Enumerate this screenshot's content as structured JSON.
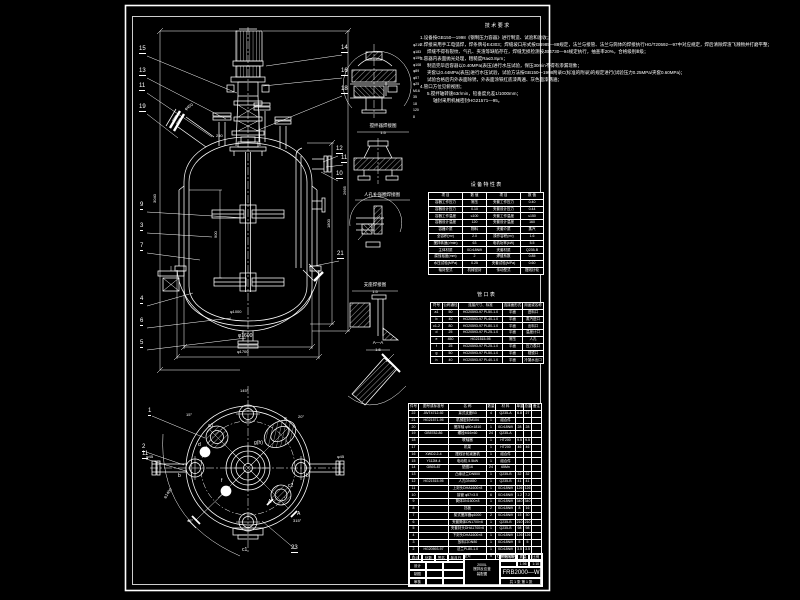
{
  "drawing": {
    "background": "#000000",
    "line_color": "#ffffff",
    "number": "FRB2000—W",
    "type_label": "搅拌反应釜装配图"
  },
  "notes": {
    "title": "技 术 要 求",
    "lines": [
      {
        "t": "1.设备按GB150—1998《钢制压力容器》进行制造、试验和验收；",
        "x": 420,
        "y": 36
      },
      {
        "t": "2.焊接采用手工电弧焊，焊条牌号E4303；焊缝坡口形式按GB985—88规定，法兰与接管、法兰与筒体的焊接执行HG/T20592—97中对应规定，焊后清除焊渣飞溅物并打磨平整；",
        "x": 420,
        "y": 43
      },
      {
        "t": "焊缝不得有裂纹、气孔、夹渣等缺陷存在，焊缝无损检测按JB4730—94规定执行，抽查率20%，合格级别Ⅲ级；",
        "x": 427,
        "y": 50
      },
      {
        "t": "3.容器内表面抛光处理，粗糙度Ra≤0.8μm；",
        "x": 420,
        "y": 57
      },
      {
        "t": "制造完毕后容器以0.40MPa(表压)进行水压试验，保压30min不得有渗漏现象；",
        "x": 427,
        "y": 64
      },
      {
        "t": "夹套以0.44MPa(表压)进行水压试验，试验方法按GB150—1998附录C(标准的附录)的规定进行(试验压力0.25MPa/夹套0.60MPa)；",
        "x": 427,
        "y": 71
      },
      {
        "t": "试验合格后内外表面除锈，外表面涂铁红底漆两遍、灰色面漆两遍；",
        "x": 427,
        "y": 78
      },
      {
        "t": "4.管口方位见俯视图；",
        "x": 420,
        "y": 85
      },
      {
        "t": "5.搅拌轴转速63r/min，铅垂度允差1/1000mm；",
        "x": 427,
        "y": 92
      },
      {
        "t": "轴封采用机械密封HG21571—95。",
        "x": 433,
        "y": 99
      }
    ]
  },
  "char_table": {
    "title": "设 备 特 性 表",
    "headers": [
      "项  目",
      "数  值",
      "项  目",
      "数  值"
    ],
    "widths": [
      34,
      24,
      34,
      23
    ],
    "rows": [
      [
        "容器工作压力",
        "常压",
        "夹套工作压力",
        "0.40"
      ],
      [
        "容器设计压力",
        "0.10",
        "夹套设计压力",
        "0.44"
      ],
      [
        "容器工作温度",
        "≤100",
        "夹套工作温度",
        "≤150"
      ],
      [
        "容器设计温度",
        "120",
        "夹套设计温度",
        "160"
      ],
      [
        "容器介质",
        "物料",
        "夹套介质",
        "蒸汽"
      ],
      [
        "全容积(m³)",
        "2.0",
        "操作容积(m³)",
        "1.6"
      ],
      [
        "搅拌转速(r/min)",
        "63",
        "电机功率(kW)",
        "5.5"
      ],
      [
        "主体材质",
        "0Cr18Ni9",
        "夹套材质",
        "Q235-B"
      ],
      [
        "腐蚀裕度(mm)",
        "2",
        "焊缝系数",
        "0.85"
      ],
      [
        "水压试验(MPa)",
        "0.25",
        "夹套试验(MPa)",
        "0.60"
      ],
      [
        "轴封型式",
        "机械密封",
        "传动型式",
        "摆线针轮"
      ]
    ]
  },
  "nozzle_table": {
    "title": "管 口 表",
    "headers": [
      "符号",
      "公称通径",
      "连接尺寸、标准",
      "连接面形式",
      "用途或名称"
    ],
    "widths": [
      12,
      16,
      44,
      20,
      21
    ],
    "rows": [
      [
        "a1",
        "50",
        "HG20593-97 PL50-1.0",
        "平面",
        "进料口"
      ],
      [
        "b",
        "40",
        "HG20593-97 PL40-1.0",
        "平面",
        "蒸汽进口"
      ],
      [
        "c1-2",
        "80",
        "HG20593-97 PL80-1.0",
        "平面",
        "出料口"
      ],
      [
        "d",
        "25",
        "HG20593-97 PL25-1.0",
        "平面",
        "温度计口"
      ],
      [
        "e",
        "450",
        "HG21515-95",
        "常压",
        "人孔"
      ],
      [
        "f",
        "25",
        "HG20593-97 PL25-1.0",
        "平面",
        "压力表口"
      ],
      [
        "g",
        "50",
        "HG20593-97 PL50-1.0",
        "平面",
        "视镜口"
      ],
      [
        "h",
        "40",
        "HG20593-97 PL40-1.0",
        "平面",
        "冷凝水出口"
      ]
    ]
  },
  "bom": {
    "headers": [
      "件号",
      "图号或标准号",
      "名  称",
      "数量",
      "材  料",
      "单重",
      "总重",
      "备注"
    ],
    "widths": [
      10,
      30,
      38,
      9,
      20,
      8,
      8,
      10
    ],
    "rows": [
      [
        "22",
        "JB/T4712-92",
        "耳式支座B3",
        "4",
        "Q235-A",
        "6.8",
        "27",
        ""
      ],
      [
        "21",
        "HG21571-95",
        "机械密封M104",
        "1",
        "组合件",
        "",
        "",
        ""
      ],
      [
        "20",
        "",
        "搅拌轴 φ50×1810",
        "1",
        "0Cr18Ni9",
        "28",
        "28",
        ""
      ],
      [
        "19",
        "GB5782-86",
        "螺栓M16×60",
        "24",
        "Q235-A",
        "",
        "",
        ""
      ],
      [
        "18",
        "",
        "联轴器",
        "1",
        "HT200",
        "9.5",
        "9.5",
        ""
      ],
      [
        "17",
        "",
        "机架",
        "1",
        "HT200",
        "46",
        "46",
        ""
      ],
      [
        "16",
        "XWD2.2-4",
        "摆线针轮减速机",
        "1",
        "组合件",
        "",
        "",
        ""
      ],
      [
        "15",
        "Y112M-4",
        "电动机 5.5kW",
        "1",
        "组合件",
        "",
        "",
        ""
      ],
      [
        "14",
        "GB93-87",
        "垫圈16",
        "24",
        "65Mn",
        "",
        "",
        ""
      ],
      [
        "13",
        "",
        "凸缘法兰DN500",
        "1",
        "Q235-B",
        "32",
        "32",
        ""
      ],
      [
        "12",
        "HG21515-95",
        "人孔DN450",
        "1",
        "Q235-B",
        "41",
        "41",
        ""
      ],
      [
        "11",
        "",
        "上封头DHA1600×8",
        "1",
        "0Cr18Ni9",
        "126",
        "126",
        ""
      ],
      [
        "10",
        "",
        "接管 φ57×3.5",
        "6",
        "0Cr18Ni9",
        "1.2",
        "7.2",
        ""
      ],
      [
        "9",
        "",
        "筒体DN1600×8",
        "1",
        "0Cr18Ni9",
        "340",
        "340",
        ""
      ],
      [
        "8",
        "",
        "挡板",
        "2",
        "0Cr18Ni9",
        "8",
        "16",
        ""
      ],
      [
        "7",
        "",
        "桨式搅拌器φ1000",
        "2",
        "0Cr18Ni9",
        "15",
        "30",
        ""
      ],
      [
        "6",
        "",
        "夹套筒体DN1700×6",
        "1",
        "Q235-B",
        "210",
        "210",
        ""
      ],
      [
        "5",
        "",
        "夹套封头DHA1700×6",
        "1",
        "Q235-B",
        "98",
        "98",
        ""
      ],
      [
        "4",
        "",
        "下封头DHA1600×8",
        "1",
        "0Cr18Ni9",
        "126",
        "126",
        ""
      ],
      [
        "3",
        "",
        "放料口DN80",
        "1",
        "0Cr18Ni9",
        "5",
        "5",
        ""
      ],
      [
        "2",
        "HG20593-97",
        "法兰PL80-1.0",
        "1",
        "0Cr18Ni9",
        "3.5",
        "3.5",
        ""
      ],
      [
        "1",
        "",
        "垫片",
        "9",
        "石棉橡胶板",
        "",
        "",
        ""
      ]
    ]
  },
  "title_block": {
    "mark": "标记",
    "count": "处数",
    "sign": "签名",
    "date": "年月日",
    "design": "设计",
    "draw": "制图",
    "check": "审核",
    "stage": "阶段标记",
    "mass_label": "质量",
    "scale_label": "比例",
    "mass": "1.96",
    "scale": "1:10",
    "name1": "2000L",
    "name2": "搅拌反应釜",
    "name3": "装配图",
    "number": "FRB2000—W",
    "sheet": "共 1 张  第 1 张"
  },
  "texts": [
    {
      "n": "balloon-15",
      "t": "15",
      "x": 139,
      "y": 46,
      "s": 6,
      "u": 1
    },
    {
      "n": "balloon-13",
      "t": "13",
      "x": 139,
      "y": 68,
      "s": 6,
      "u": 1
    },
    {
      "n": "balloon-11",
      "t": "11",
      "x": 139,
      "y": 83,
      "s": 6,
      "u": 1
    },
    {
      "n": "balloon-19",
      "t": "19",
      "x": 139,
      "y": 104,
      "s": 6,
      "u": 1
    },
    {
      "n": "balloon-9",
      "t": "9",
      "x": 140,
      "y": 202,
      "s": 6,
      "u": 1
    },
    {
      "n": "balloon-3",
      "t": "3",
      "x": 140,
      "y": 223,
      "s": 6,
      "u": 1
    },
    {
      "n": "balloon-7",
      "t": "7",
      "x": 140,
      "y": 243,
      "s": 6,
      "u": 1
    },
    {
      "n": "balloon-4",
      "t": "4",
      "x": 140,
      "y": 296,
      "s": 6,
      "u": 1
    },
    {
      "n": "balloon-6",
      "t": "6",
      "x": 140,
      "y": 318,
      "s": 6,
      "u": 1
    },
    {
      "n": "balloon-5",
      "t": "5",
      "x": 140,
      "y": 340,
      "s": 6,
      "u": 1
    },
    {
      "n": "balloon-14",
      "t": "14",
      "x": 341,
      "y": 45,
      "s": 6,
      "u": 1
    },
    {
      "n": "balloon-16",
      "t": "16",
      "x": 341,
      "y": 68,
      "s": 6,
      "u": 1
    },
    {
      "n": "balloon-18",
      "t": "18",
      "x": 341,
      "y": 86,
      "s": 6,
      "u": 1
    },
    {
      "n": "balloon-12",
      "t": "12",
      "x": 336,
      "y": 146,
      "s": 6,
      "u": 1
    },
    {
      "n": "balloon-11r",
      "t": "11",
      "x": 341,
      "y": 155,
      "s": 6,
      "u": 1
    },
    {
      "n": "balloon-10",
      "t": "10",
      "x": 336,
      "y": 171,
      "s": 6,
      "u": 1
    },
    {
      "n": "balloon-21",
      "t": "21",
      "x": 337,
      "y": 251,
      "s": 6,
      "u": 1
    },
    {
      "n": "balloon-plan-1",
      "t": "1",
      "x": 148,
      "y": 408,
      "s": 6,
      "u": 1
    },
    {
      "n": "balloon-plan-2",
      "t": "2",
      "x": 142,
      "y": 444,
      "s": 6,
      "u": 1
    },
    {
      "n": "balloon-plan-11",
      "t": "11",
      "x": 142,
      "y": 451,
      "s": 6,
      "u": 1
    },
    {
      "n": "balloon-plan-23",
      "t": "23",
      "x": 291,
      "y": 545,
      "s": 6,
      "u": 1
    },
    {
      "n": "plan-label-a1",
      "t": "a1",
      "x": 208,
      "y": 424,
      "s": 5
    },
    {
      "n": "plan-label-d",
      "t": "d",
      "x": 198,
      "y": 443,
      "s": 5
    },
    {
      "n": "plan-label-e",
      "t": "e",
      "x": 284,
      "y": 417,
      "s": 5
    },
    {
      "n": "plan-label-gh",
      "t": "g(h)",
      "x": 254,
      "y": 441,
      "s": 5
    },
    {
      "n": "plan-label-f",
      "t": "f",
      "x": 221,
      "y": 479,
      "s": 5
    },
    {
      "n": "plan-label-c2",
      "t": "c2",
      "x": 288,
      "y": 484,
      "s": 5
    },
    {
      "n": "plan-label-A1",
      "t": "A",
      "x": 268,
      "y": 500,
      "s": 5
    },
    {
      "n": "plan-label-A2",
      "t": "A",
      "x": 297,
      "y": 512,
      "s": 5
    },
    {
      "n": "plan-label-b1",
      "t": "b",
      "x": 178,
      "y": 474,
      "s": 5
    },
    {
      "n": "plan-label-b2",
      "t": "b",
      "x": 306,
      "y": 474,
      "s": 5
    },
    {
      "n": "plan-label-c1",
      "t": "c1",
      "x": 242,
      "y": 548,
      "s": 5
    },
    {
      "n": "plan-angle-15",
      "t": "15°",
      "x": 186,
      "y": 413,
      "s": 4
    },
    {
      "n": "plan-angle-20",
      "t": "20°",
      "x": 298,
      "y": 415,
      "s": 4
    },
    {
      "n": "plan-angle-45",
      "t": "45°",
      "x": 187,
      "y": 519,
      "s": 4
    },
    {
      "n": "plan-angle-315",
      "t": "315°",
      "x": 293,
      "y": 519,
      "s": 4
    },
    {
      "n": "plan-angle-145",
      "t": "145°",
      "x": 240,
      "y": 389,
      "s": 4
    },
    {
      "n": "plan-dim-w",
      "t": "φ45",
      "x": 146,
      "y": 455,
      "s": 4
    },
    {
      "n": "plan-dim-e",
      "t": "φ45",
      "x": 337,
      "y": 455,
      "s": 4
    },
    {
      "n": "plan-dim-bc",
      "t": "φ1400",
      "x": 163,
      "y": 497,
      "s": 4,
      "r": -55
    },
    {
      "n": "dim-manhole",
      "t": "φ450",
      "x": 184,
      "y": 108,
      "s": 4,
      "r": -35
    },
    {
      "n": "dim-250",
      "t": "250",
      "x": 216,
      "y": 134,
      "s": 4
    },
    {
      "n": "dim-900",
      "t": "900",
      "x": 214,
      "y": 238,
      "s": 4,
      "r": -90
    },
    {
      "n": "dim-impeller",
      "t": "φ1000",
      "x": 230,
      "y": 310,
      "s": 4
    },
    {
      "n": "dim-shell",
      "t": "φ1600",
      "x": 238,
      "y": 334,
      "s": 5
    },
    {
      "n": "dim-jacket",
      "t": "φ1700",
      "x": 237,
      "y": 350,
      "s": 4
    },
    {
      "n": "dim-3040",
      "t": "3040",
      "x": 153,
      "y": 203,
      "s": 4,
      "r": -90
    },
    {
      "n": "dim-1800",
      "t": "1800",
      "x": 327,
      "y": 228,
      "s": 4,
      "r": -90
    },
    {
      "n": "dim-2665",
      "t": "2665",
      "x": 343,
      "y": 195,
      "s": 4,
      "r": -90
    },
    {
      "n": "detail-dim-1",
      "t": "φ219",
      "x": 413,
      "y": 44,
      "s": 3.5
    },
    {
      "n": "detail-dim-2",
      "t": "φ183",
      "x": 413,
      "y": 50.5,
      "s": 3.5
    },
    {
      "n": "detail-dim-3",
      "t": "φ159",
      "x": 413,
      "y": 57,
      "s": 3.5
    },
    {
      "n": "detail-dim-4",
      "t": "φ108",
      "x": 413,
      "y": 63.5,
      "s": 3.5
    },
    {
      "n": "detail-dim-5",
      "t": "φ89",
      "x": 413,
      "y": 70,
      "s": 3.5
    },
    {
      "n": "detail-dim-6",
      "t": "φ57",
      "x": 413,
      "y": 76.5,
      "s": 3.5
    },
    {
      "n": "detail-dim-7",
      "t": "φ25",
      "x": 413,
      "y": 83,
      "s": 3.5
    },
    {
      "n": "detail-dim-8",
      "t": "M16",
      "x": 413,
      "y": 89.5,
      "s": 3.5
    },
    {
      "n": "detail-dim-9",
      "t": "35",
      "x": 413,
      "y": 96,
      "s": 3.5
    },
    {
      "n": "detail-dim-10",
      "t": "18",
      "x": 413,
      "y": 102.5,
      "s": 3.5
    },
    {
      "n": "detail-dim-11",
      "t": "120",
      "x": 413,
      "y": 109,
      "s": 3.5
    },
    {
      "n": "detail-dim-12",
      "t": "8",
      "x": 413,
      "y": 115.5,
      "s": 3.5
    },
    {
      "n": "detail2-title",
      "t": "搅拌器焊接图",
      "x": 383,
      "y": 124,
      "s": 4.5,
      "c": 1
    },
    {
      "n": "detail2-scale",
      "t": "1:5",
      "x": 383,
      "y": 131,
      "s": 4,
      "c": 1
    },
    {
      "n": "detail3-title",
      "t": "人孔补强圈焊接图",
      "x": 382,
      "y": 193,
      "s": 4.5,
      "c": 1
    },
    {
      "n": "detail4-title",
      "t": "支座焊接图",
      "x": 375,
      "y": 283,
      "s": 4.5,
      "c": 1
    },
    {
      "n": "detail4-scale",
      "t": "1:5",
      "x": 375,
      "y": 290,
      "s": 4,
      "c": 1
    },
    {
      "n": "detail5-title",
      "t": "A—A",
      "x": 378,
      "y": 341,
      "s": 4.5,
      "c": 1
    },
    {
      "n": "detail5-scale",
      "t": "1:5",
      "x": 378,
      "y": 348,
      "s": 4,
      "c": 1
    },
    {
      "n": "notes-title",
      "t": "技 术 要 求",
      "x": 497,
      "y": 24,
      "s": 5,
      "c": 1
    },
    {
      "n": "char-table-title",
      "t": "设 备 特 性 表",
      "x": 486,
      "y": 183,
      "s": 5,
      "c": 1
    },
    {
      "n": "nozzle-table-title",
      "t": "管 口 表",
      "x": 486,
      "y": 293,
      "s": 5,
      "c": 1
    }
  ]
}
